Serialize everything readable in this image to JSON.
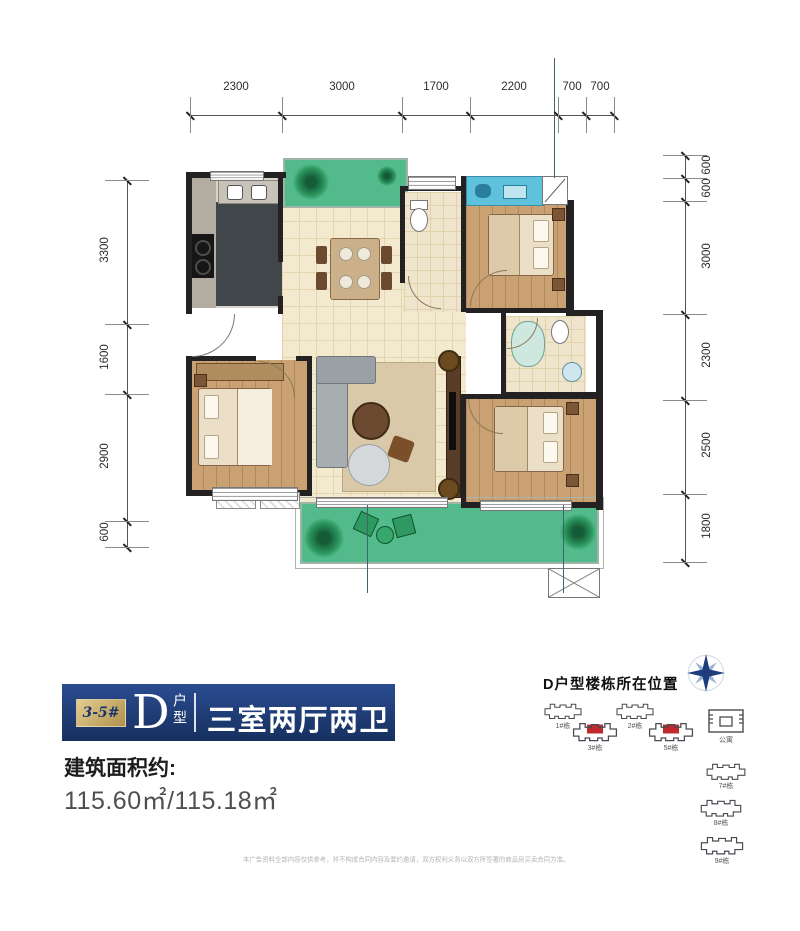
{
  "floor_plan": {
    "dims_top": [
      "2300",
      "3000",
      "1700",
      "2200",
      "700",
      "700"
    ],
    "dims_left": [
      "3300",
      "1600",
      "2900",
      "600"
    ],
    "dims_right": [
      "600",
      "600",
      "3000",
      "2300",
      "2500",
      "1800"
    ]
  },
  "info": {
    "building_badge": "3-5#",
    "unit_letter": "D",
    "unit_type_label": "户型",
    "layout_title": "三室两厅两卫",
    "area_label": "建筑面积约:",
    "area_value": "115.60㎡/115.18㎡"
  },
  "location": {
    "heading": "D户型楼栋所在位置",
    "highlight_color": "#bf2a2e",
    "buildings": [
      {
        "label": "1#栋",
        "highlighted": false,
        "kind": "residential"
      },
      {
        "label": "2#栋",
        "highlighted": false,
        "kind": "residential"
      },
      {
        "label": "3#栋",
        "highlighted": true,
        "kind": "residential"
      },
      {
        "label": "5#栋",
        "highlighted": true,
        "kind": "residential"
      },
      {
        "label": "公寓",
        "highlighted": false,
        "kind": "apartment"
      },
      {
        "label": "7#栋",
        "highlighted": false,
        "kind": "residential"
      },
      {
        "label": "8#栋",
        "highlighted": false,
        "kind": "residential"
      },
      {
        "label": "9#栋",
        "highlighted": false,
        "kind": "residential"
      }
    ]
  },
  "disclaimer": "本广告资料全部内容仅供参考，并不构成合同内容及要约邀请，双方权利义务以双方所签署的商品房买卖合同为准。"
}
